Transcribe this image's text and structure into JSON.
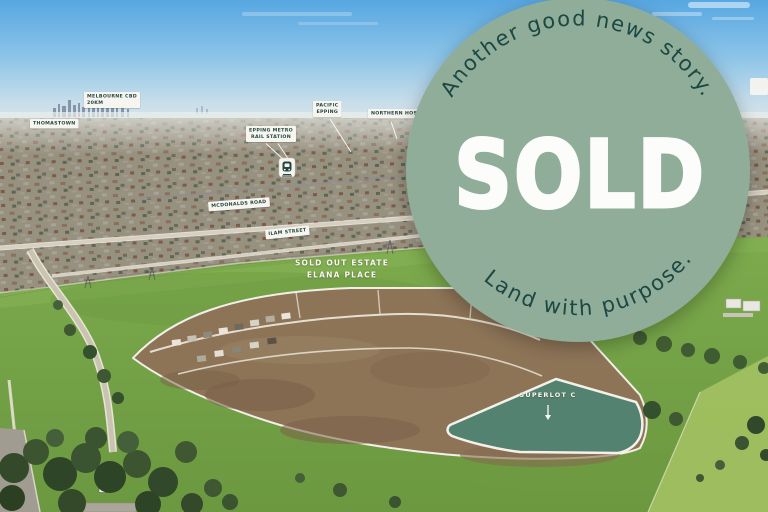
{
  "badge": {
    "top_arc_text": "Another good news story.",
    "main_text": "SOLD",
    "bottom_arc_text": "Land with purpose.",
    "circle_color": "#8FAD99",
    "arc_text_color": "#1C4843",
    "main_text_color": "#FCFCFA"
  },
  "map_labels": {
    "melbourne_cbd_line1": "MELBOURNE CBD",
    "melbourne_cbd_line2": "20KM",
    "thomastown": "THOMASTOWN",
    "epping_metro_line1": "EPPING METRO",
    "epping_metro_line2": "RAIL STATION",
    "pacific_epping_line1": "PACIFIC",
    "pacific_epping_line2": "EPPING",
    "northern_hospital": "NORTHERN HOS",
    "mcdonalds_road": "MCDONALDS ROAD",
    "ilam_street": "ILAM STREET"
  },
  "site_annotations": {
    "estate_line1": "SOLD OUT ESTATE",
    "estate_line2": "ELANA PLACE",
    "superlot": "SUPERLOT C"
  },
  "icons": {
    "train_station": "train-icon",
    "superlot_pointer": "down-arrow-icon"
  },
  "colors": {
    "label_bg": "#F7F5F0",
    "label_text": "#24463F",
    "sky_top": "#57A7E2",
    "field_green": "#74A145",
    "estate_dirt": "#8D7457",
    "superlot_fill": "#4F8373"
  }
}
